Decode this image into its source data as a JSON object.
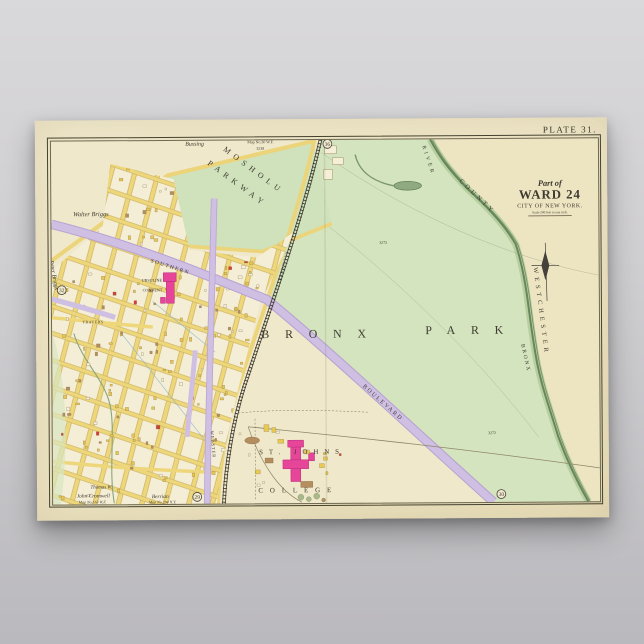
{
  "poster": {
    "plate": "PLATE 31.",
    "title": {
      "part_of": "Part of",
      "ward": "WARD 24",
      "city": "CITY OF NEW YORK.",
      "scale": "Scale 200 feet to one inch."
    }
  },
  "map": {
    "labels": {
      "park_word1": "BRONX",
      "park_word2": "PARK",
      "mosholu": "MOSHOLU",
      "parkway": "PARKWAY",
      "bussing": "Bussing",
      "bussing_map": "Map No.30 W.F.",
      "bussing_block": "3238",
      "walter_briggs": "Walter Briggs",
      "peter_briggs": "Peter Briggs",
      "southern": "SOUTHERN",
      "boulevard": "BOULEVARD",
      "webster": "WEBSTER",
      "travers": "TRAVERS",
      "ursuline_1": "URSULINE",
      "ursuline_2": "CONVENT",
      "st_johns": "ST. JOHNS",
      "college": "COLLEGE",
      "river_word1": "BRONX",
      "river_word2": "RIVER",
      "county": "COUNTY",
      "westchester": "WESTCHESTER",
      "acreage_1": "3272",
      "acreage_2": "3272",
      "railroad": "N.Y.C.& H.R.R.R.",
      "thomas": "Thomas W.",
      "cromwell": "John Cromwell",
      "cromwell_map": "Map No.163 W.F.",
      "berrian": "Berrian",
      "berrian_map": "Map No.294 N.Y.",
      "markers": {
        "top": "36",
        "left": "32",
        "bottom_left": "29",
        "bottom_right": "30"
      }
    },
    "colors": {
      "sheet": "#f0e8ca",
      "park_green": "#d4e4bf",
      "river_green": "#69855c",
      "street_yellow": "#eed77b",
      "road_purple": "#cfc0e3",
      "building_pink": "#e6459a",
      "building_brown": "#b58e5f",
      "ink": "#3f3b31",
      "background_gray": "#c3c2c6"
    }
  }
}
